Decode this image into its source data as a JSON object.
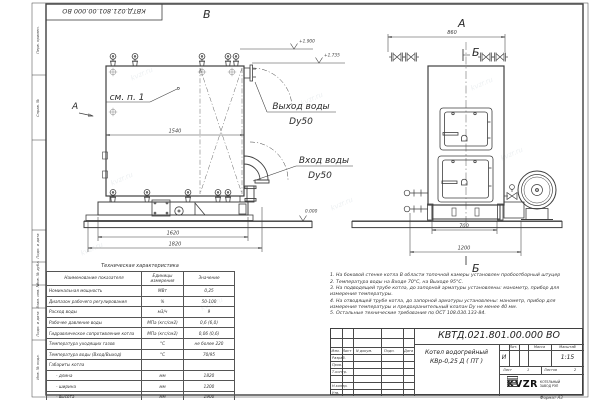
{
  "frame": {
    "stamp": "КВТД.021.801.00.000 ВО",
    "side_labels": [
      "Перв. примен.",
      "Справ. №",
      "Подп. и дата",
      "Инв. № дубл.",
      "Взам. инв. №",
      "Подп. и дата",
      "Инв. № подл."
    ],
    "format_note": "Формат  А3"
  },
  "watermark": "kvzr.ru",
  "views": {
    "front_label": "В",
    "side_label": "А",
    "view_arrow_label": "А",
    "section_label": "Б",
    "see_note": "см. п. 1",
    "outlet": {
      "line1": "Выход воды",
      "line2": "Dy50"
    },
    "inlet": {
      "line1": "Вход воды",
      "line2": "Dy50"
    },
    "elevations": {
      "top": "+1.900",
      "mid": "+1.735",
      "ground": "0.000"
    },
    "dims": {
      "front_width": "1540",
      "front_base": "1620",
      "front_total": "1820",
      "side_top": "860",
      "side_base": "700",
      "side_total": "1200"
    }
  },
  "table": {
    "title": "Техническая характеристика",
    "headers": [
      "Наименование показателя",
      "Единицы измерения",
      "Значение"
    ],
    "rows": [
      {
        "name": "Номинальная мощность",
        "unit": "МВт",
        "value": "0,25"
      },
      {
        "name": "Диапазон рабочего регулирования",
        "unit": "%",
        "value": "50-100"
      },
      {
        "name": "Расход воды",
        "unit": "м3/ч",
        "value": "9"
      },
      {
        "name": "Рабочее давление воды",
        "unit": "МПа (кгс/см2)",
        "value": "0,6 (6,0)"
      },
      {
        "name": "Гидравлическое сопротивление котла",
        "unit": "МПа (кгс/см2)",
        "value": "0,06 (0,6)"
      },
      {
        "name": "Температура уходящих газов",
        "unit": "°С",
        "value": "не более 220"
      },
      {
        "name": "Температура воды (Вход/Выход)",
        "unit": "°С",
        "value": "70/95"
      },
      {
        "name": "Габариты котла",
        "unit": "",
        "value": ""
      },
      {
        "name": "- длина",
        "unit": "мм",
        "value": "1820"
      },
      {
        "name": "- ширина",
        "unit": "мм",
        "value": "1200"
      },
      {
        "name": "- высота",
        "unit": "мм",
        "value": "1900"
      }
    ]
  },
  "notes": [
    "1.  На боковой стенке котла В области топочной камеры установлен пробоотборный штуцер",
    "2.  Температура воды на Входе 70°С, на Выходе 95°С.",
    "3.  На подводящей трубе котла, до запорной арматуры установлены: манометр, прибор для измерения температуры.",
    "4.  На отводящей трубе котла, до запорной арматуры установлены: манометр, прибор для измерения температуры и предохранительный клапан Dу не менее 40 мм.",
    "5.  Остальные технические требования по ОСТ 108.030.133-84."
  ],
  "title_block": {
    "doc_number": "КВТД.021.801.00.000  ВО",
    "product_name_line1": "Котел водогрейный",
    "product_name_line2": "КВр-0,25  Д  ( ПТ )",
    "col_izm": "Изм.",
    "col_list": "Лист",
    "col_doc": "N докум.",
    "col_podp": "Подп.",
    "col_data": "Дата",
    "row_razrab": "Разраб.",
    "row_prov": "Пров.",
    "row_tkontr": "Т.контр.",
    "row_nkontr": "Н.контр.",
    "row_utv": "Утв.",
    "lit_header": "Лит.",
    "mass_header": "Масса",
    "scale_header": "Масштаб",
    "lit_value": "И",
    "scale_value": "1:15",
    "sheet_label": "Лист",
    "sheet_value": "1",
    "sheets_label": "Листов",
    "sheets_value": "2",
    "company_logo": "KVZR",
    "company_line1": "КОТЕЛЬНЫЙ",
    "company_line2": "ЗАВОД РЭП"
  }
}
